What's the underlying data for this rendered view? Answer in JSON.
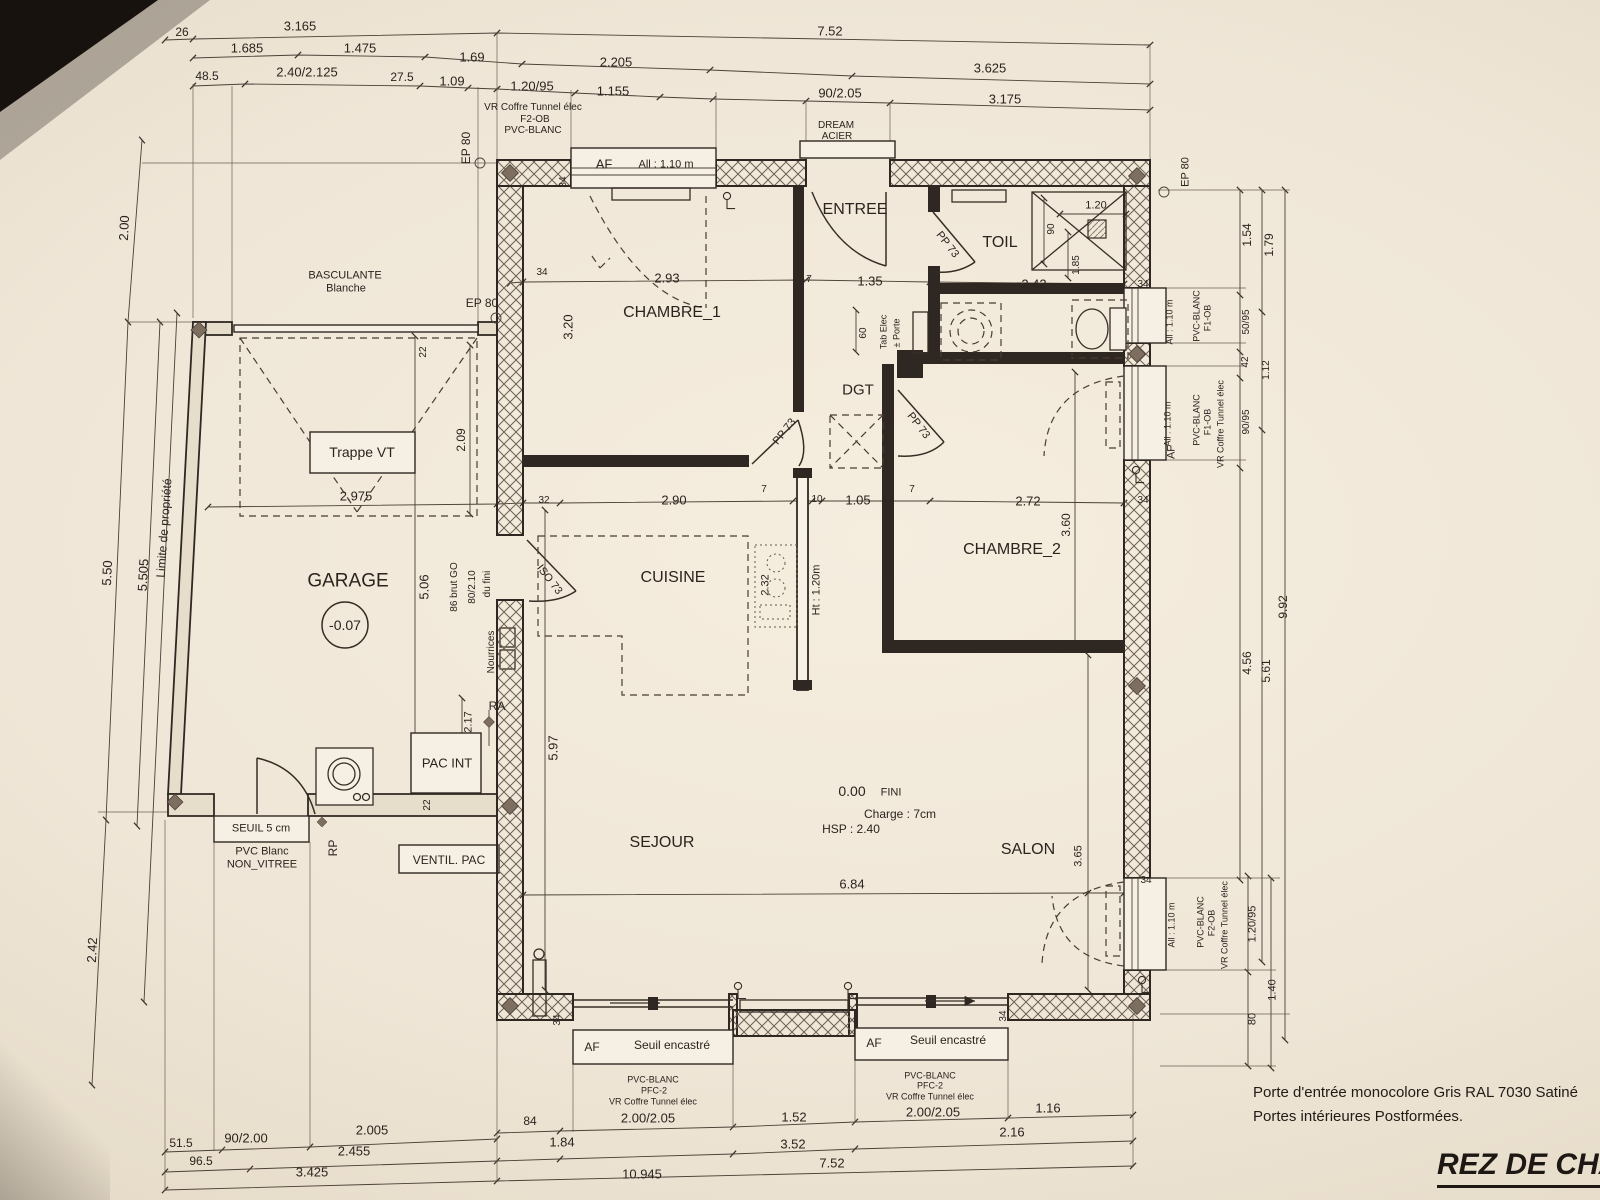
{
  "title": "REZ DE CHAU",
  "notes": [
    "Porte d'entrée monocolore Gris RAL 7030 Satiné",
    "Portes intérieures Postformées."
  ],
  "rooms": [
    "GARAGE",
    "CHAMBRE_1",
    "ENTREE",
    "TOIL",
    "DGT",
    "CHAMBRE_2",
    "CUISINE",
    "SEJOUR",
    "SALON"
  ],
  "levels": {
    "garage": "-0.07",
    "ground_floor": "0.00",
    "finish": "FINI",
    "charge": "Charge : 7cm",
    "ceiling": "HSP : 2.40"
  },
  "labels": [
    {
      "n": "dim-label",
      "t": "26",
      "x": 182,
      "y": 32,
      "s": 12
    },
    {
      "n": "dim-label",
      "t": "3.165",
      "x": 300,
      "y": 26
    },
    {
      "n": "dim-label",
      "t": "7.52",
      "x": 830,
      "y": 31
    },
    {
      "n": "dim-label",
      "t": "1.685",
      "x": 247,
      "y": 48
    },
    {
      "n": "dim-label",
      "t": "1.475",
      "x": 360,
      "y": 48
    },
    {
      "n": "dim-label",
      "t": "1.69",
      "x": 472,
      "y": 57
    },
    {
      "n": "dim-label",
      "t": "2.205",
      "x": 616,
      "y": 62
    },
    {
      "n": "dim-label",
      "t": "3.625",
      "x": 990,
      "y": 68
    },
    {
      "n": "dim-label",
      "t": "48.5",
      "x": 207,
      "y": 76,
      "s": 12
    },
    {
      "n": "dim-label",
      "t": "2.40/2.125",
      "x": 307,
      "y": 72
    },
    {
      "n": "dim-label",
      "t": "27.5",
      "x": 402,
      "y": 77,
      "s": 12
    },
    {
      "n": "dim-label",
      "t": "1.09",
      "x": 452,
      "y": 81
    },
    {
      "n": "dim-label",
      "t": "1.20/95",
      "x": 532,
      "y": 86
    },
    {
      "n": "dim-label",
      "t": "1.155",
      "x": 613,
      "y": 91
    },
    {
      "n": "dim-label",
      "t": "90/2.05",
      "x": 840,
      "y": 93
    },
    {
      "n": "dim-label",
      "t": "3.175",
      "x": 1005,
      "y": 99
    },
    {
      "n": "window-spec-label",
      "t": "VR Coffre Tunnel élec",
      "x": 533,
      "y": 108,
      "s": 10
    },
    {
      "n": "window-spec-label",
      "t": "F2-OB",
      "x": 535,
      "y": 120,
      "s": 10
    },
    {
      "n": "window-spec-label",
      "t": "PVC-BLANC",
      "x": 533,
      "y": 131,
      "s": 10
    },
    {
      "n": "door-material-label",
      "t": "DREAM",
      "x": 836,
      "y": 126,
      "s": 10
    },
    {
      "n": "door-material-label",
      "t": "ACIER",
      "x": 837,
      "y": 137,
      "s": 10
    },
    {
      "n": "dim-label",
      "t": "2.00",
      "x": 124,
      "y": 228,
      "r": -87
    },
    {
      "n": "dim-label",
      "t": "5.50",
      "x": 107,
      "y": 573,
      "r": -87
    },
    {
      "n": "dim-label",
      "t": "5.505",
      "x": 143,
      "y": 575,
      "r": -87
    },
    {
      "n": "dim-label",
      "t": "2.42",
      "x": 92,
      "y": 950,
      "r": -87
    },
    {
      "n": "property-limit-label",
      "t": "Limite de propriété",
      "x": 164,
      "y": 528,
      "r": -86,
      "s": 12
    },
    {
      "n": "wall-spec-label",
      "t": "EP 80",
      "x": 466,
      "y": 148,
      "r": -90,
      "s": 12
    },
    {
      "n": "window-label",
      "t": "AF",
      "x": 604,
      "y": 164,
      "s": 13
    },
    {
      "n": "window-label",
      "t": "All : 1.10 m",
      "x": 666,
      "y": 165,
      "s": 11
    },
    {
      "n": "room-label-entree",
      "t": "ENTREE",
      "x": 855,
      "y": 210,
      "s": 16
    },
    {
      "n": "door-label-pp73",
      "t": "PP 73",
      "x": 947,
      "y": 245,
      "r": 52,
      "s": 11
    },
    {
      "n": "room-label-toil",
      "t": "TOIL",
      "x": 1000,
      "y": 243,
      "s": 16
    },
    {
      "n": "dim-label",
      "t": "90",
      "x": 1052,
      "y": 229,
      "r": -90,
      "s": 10
    },
    {
      "n": "dim-label",
      "t": "1.20",
      "x": 1096,
      "y": 206,
      "s": 11
    },
    {
      "n": "dim-label",
      "t": "1.85",
      "x": 1077,
      "y": 265,
      "r": -90,
      "s": 10
    },
    {
      "n": "dim-label",
      "t": "2.42",
      "x": 1034,
      "y": 284
    },
    {
      "n": "dim-label",
      "t": "34",
      "x": 1143,
      "y": 285,
      "s": 10
    },
    {
      "n": "garage-door-label",
      "t": "BASCULANTE",
      "x": 345,
      "y": 276,
      "s": 11
    },
    {
      "n": "garage-door-label",
      "t": "Blanche",
      "x": 346,
      "y": 289,
      "s": 11
    },
    {
      "n": "wall-spec-label",
      "t": "EP 80",
      "x": 482,
      "y": 303,
      "s": 12
    },
    {
      "n": "dim-label",
      "t": "22",
      "x": 424,
      "y": 352,
      "r": -90,
      "s": 10
    },
    {
      "n": "dim-label",
      "t": "34",
      "x": 564,
      "y": 182,
      "r": -90,
      "s": 10
    },
    {
      "n": "dim-label",
      "t": "34",
      "x": 542,
      "y": 273,
      "s": 10
    },
    {
      "n": "dim-label",
      "t": "2.93",
      "x": 667,
      "y": 278
    },
    {
      "n": "dim-label",
      "t": "7",
      "x": 809,
      "y": 280,
      "s": 10
    },
    {
      "n": "dim-label",
      "t": "1.35",
      "x": 870,
      "y": 281
    },
    {
      "n": "dim-label",
      "t": "3.20",
      "x": 568,
      "y": 327,
      "r": -90
    },
    {
      "n": "room-label-chambre1",
      "t": "CHAMBRE_1",
      "x": 672,
      "y": 313,
      "s": 16
    },
    {
      "n": "dim-label",
      "t": "60",
      "x": 864,
      "y": 333,
      "r": -90,
      "s": 10
    },
    {
      "n": "elec-label",
      "t": "Tab Elec",
      "x": 884,
      "y": 332,
      "r": -90,
      "s": 9
    },
    {
      "n": "elec-label",
      "t": "± Porte",
      "x": 897,
      "y": 333,
      "r": -90,
      "s": 9
    },
    {
      "n": "window-spec-label",
      "t": "All : 1.10 m",
      "x": 1170,
      "y": 322,
      "r": -90,
      "s": 9
    },
    {
      "n": "window-spec-label",
      "t": "PVC-BLANC",
      "x": 1197,
      "y": 316,
      "r": -90,
      "s": 9
    },
    {
      "n": "window-spec-label",
      "t": "F1-OB",
      "x": 1208,
      "y": 318,
      "r": -90,
      "s": 9
    },
    {
      "n": "wall-spec-label",
      "t": "EP 80",
      "x": 1186,
      "y": 172,
      "r": -90,
      "s": 11
    },
    {
      "n": "dim-label",
      "t": "1.54",
      "x": 1247,
      "y": 235,
      "r": -90,
      "s": 12
    },
    {
      "n": "dim-label",
      "t": "1.79",
      "x": 1269,
      "y": 245,
      "r": -90,
      "s": 12
    },
    {
      "n": "dim-label",
      "t": "50/95",
      "x": 1247,
      "y": 322,
      "r": -90,
      "s": 10
    },
    {
      "n": "dim-label",
      "t": "42",
      "x": 1246,
      "y": 362,
      "r": -90,
      "s": 10
    },
    {
      "n": "dim-label",
      "t": "1.12",
      "x": 1267,
      "y": 370,
      "r": -90,
      "s": 10
    },
    {
      "n": "dim-label",
      "t": "90/95",
      "x": 1247,
      "y": 422,
      "r": -90,
      "s": 10
    },
    {
      "n": "window-spec-label",
      "t": "All : 1.10 m",
      "x": 1168,
      "y": 424,
      "r": -90,
      "s": 9
    },
    {
      "n": "window-label",
      "t": "AF",
      "x": 1172,
      "y": 452,
      "r": -90,
      "s": 11
    },
    {
      "n": "window-spec-label",
      "t": "PVC-BLANC",
      "x": 1197,
      "y": 420,
      "r": -90,
      "s": 9
    },
    {
      "n": "window-spec-label",
      "t": "F1-OB",
      "x": 1208,
      "y": 422,
      "r": -90,
      "s": 9
    },
    {
      "n": "window-spec-label",
      "t": "VR Coffre Tunnel élec",
      "x": 1221,
      "y": 424,
      "r": -90,
      "s": 9
    },
    {
      "n": "dim-label",
      "t": "9.92",
      "x": 1283,
      "y": 607,
      "r": -90,
      "s": 12
    },
    {
      "n": "dim-label",
      "t": "4.56",
      "x": 1247,
      "y": 663,
      "r": -90,
      "s": 12
    },
    {
      "n": "dim-label",
      "t": "5.61",
      "x": 1266,
      "y": 671,
      "r": -90,
      "s": 12
    },
    {
      "n": "room-label-dgt",
      "t": "DGT",
      "x": 858,
      "y": 390,
      "s": 15
    },
    {
      "n": "door-label-pp73",
      "t": "PP 73",
      "x": 785,
      "y": 432,
      "r": -52,
      "s": 11
    },
    {
      "n": "door-label-pp73",
      "t": "PP 73",
      "x": 918,
      "y": 426,
      "r": 52,
      "s": 11
    },
    {
      "n": "hatch-label",
      "t": "Trappe VT",
      "x": 362,
      "y": 452,
      "s": 14
    },
    {
      "n": "dim-label",
      "t": "2.09",
      "x": 461,
      "y": 440,
      "r": -90,
      "s": 12
    },
    {
      "n": "dim-label",
      "t": "2.975",
      "x": 356,
      "y": 496
    },
    {
      "n": "dim-label",
      "t": "32",
      "x": 544,
      "y": 501,
      "s": 10
    },
    {
      "n": "dim-label",
      "t": "2.90",
      "x": 674,
      "y": 500
    },
    {
      "n": "dim-label",
      "t": "7",
      "x": 764,
      "y": 490,
      "s": 10
    },
    {
      "n": "dim-label",
      "t": "10",
      "x": 817,
      "y": 500,
      "s": 10
    },
    {
      "n": "dim-label",
      "t": "1.05",
      "x": 858,
      "y": 500
    },
    {
      "n": "dim-label",
      "t": "7",
      "x": 912,
      "y": 490,
      "s": 10
    },
    {
      "n": "dim-label",
      "t": "2.72",
      "x": 1028,
      "y": 501
    },
    {
      "n": "dim-label",
      "t": "34",
      "x": 1143,
      "y": 501,
      "s": 10
    },
    {
      "n": "dim-label",
      "t": "3.60",
      "x": 1066,
      "y": 525,
      "r": -90,
      "s": 12
    },
    {
      "n": "room-label-chambre2",
      "t": "CHAMBRE_2",
      "x": 1012,
      "y": 550,
      "s": 16
    },
    {
      "n": "room-label-garage",
      "t": "GARAGE",
      "x": 348,
      "y": 581,
      "s": 19
    },
    {
      "n": "level-label-garage",
      "t": "-0.07",
      "x": 345,
      "y": 625,
      "s": 14
    },
    {
      "n": "dim-label",
      "t": "5.06",
      "x": 424,
      "y": 587,
      "r": -90
    },
    {
      "n": "dim-label",
      "t": "86 brut GO",
      "x": 455,
      "y": 587,
      "r": -90,
      "s": 10
    },
    {
      "n": "dim-label",
      "t": "80/2.10",
      "x": 473,
      "y": 587,
      "r": -90,
      "s": 10
    },
    {
      "n": "dim-label",
      "t": "du fini",
      "x": 488,
      "y": 584,
      "r": -90,
      "s": 10
    },
    {
      "n": "door-label-iso73",
      "t": "ISO 73",
      "x": 549,
      "y": 580,
      "r": 52,
      "s": 11
    },
    {
      "n": "room-label-cuisine",
      "t": "CUISINE",
      "x": 673,
      "y": 578,
      "s": 16
    },
    {
      "n": "dim-label",
      "t": "2.32",
      "x": 766,
      "y": 585,
      "r": -90,
      "s": 11
    },
    {
      "n": "dim-label",
      "t": "Ht : 1.20m",
      "x": 817,
      "y": 590,
      "r": -90,
      "s": 11
    },
    {
      "n": "plumbing-label",
      "t": "Nourrices",
      "x": 492,
      "y": 652,
      "r": -90,
      "s": 10
    },
    {
      "n": "plumbing-label",
      "t": "RA",
      "x": 497,
      "y": 706,
      "s": 12
    },
    {
      "n": "dim-label",
      "t": "2.17",
      "x": 469,
      "y": 722,
      "r": -90,
      "s": 11
    },
    {
      "n": "equipment-label",
      "t": "PAC INT",
      "x": 447,
      "y": 763,
      "s": 13
    },
    {
      "n": "dim-label",
      "t": "5.97",
      "x": 553,
      "y": 748,
      "r": -90
    },
    {
      "n": "level-label-rdc",
      "t": "0.00",
      "x": 852,
      "y": 791,
      "s": 14
    },
    {
      "n": "finish-label",
      "t": "FINI",
      "x": 891,
      "y": 793,
      "s": 11
    },
    {
      "n": "charge-label",
      "t": "Charge : 7cm",
      "x": 900,
      "y": 814,
      "s": 12
    },
    {
      "n": "ceiling-label",
      "t": "HSP : 2.40",
      "x": 851,
      "y": 829,
      "s": 12
    },
    {
      "n": "room-label-sejour",
      "t": "SEJOUR",
      "x": 662,
      "y": 843,
      "s": 16
    },
    {
      "n": "room-label-salon",
      "t": "SALON",
      "x": 1028,
      "y": 850,
      "s": 16
    },
    {
      "n": "dim-label",
      "t": "3.65",
      "x": 1079,
      "y": 856,
      "r": -90,
      "s": 11
    },
    {
      "n": "dim-label",
      "t": "6.84",
      "x": 852,
      "y": 884
    },
    {
      "n": "dim-label",
      "t": "34",
      "x": 1146,
      "y": 881,
      "s": 10
    },
    {
      "n": "dim-label",
      "t": "22",
      "x": 428,
      "y": 805,
      "r": -90,
      "s": 10
    },
    {
      "n": "dim-label",
      "t": "7",
      "x": 1057,
      "y": 650,
      "r": -90,
      "s": 10
    },
    {
      "n": "dim-label",
      "t": "7",
      "x": 1072,
      "y": 356,
      "r": -90,
      "s": 10
    },
    {
      "n": "threshold-label",
      "t": "SEUIL 5 cm",
      "x": 261,
      "y": 829,
      "s": 11
    },
    {
      "n": "door-spec-label",
      "t": "PVC Blanc",
      "x": 262,
      "y": 852,
      "s": 11
    },
    {
      "n": "door-spec-label",
      "t": "NON_VITREE",
      "x": 262,
      "y": 865,
      "s": 11
    },
    {
      "n": "plumbing-label",
      "t": "RP",
      "x": 333,
      "y": 848,
      "r": -90,
      "s": 12
    },
    {
      "n": "equipment-label",
      "t": "VENTIL. PAC",
      "x": 449,
      "y": 860,
      "s": 12
    },
    {
      "n": "dim-label",
      "t": "34",
      "x": 558,
      "y": 1020,
      "r": -90,
      "s": 10
    },
    {
      "n": "dim-label",
      "t": "34",
      "x": 1004,
      "y": 1016,
      "r": -90,
      "s": 10
    },
    {
      "n": "window-label",
      "t": "AF",
      "x": 592,
      "y": 1047,
      "s": 12
    },
    {
      "n": "threshold-label",
      "t": "Seuil encastré",
      "x": 672,
      "y": 1045,
      "s": 12
    },
    {
      "n": "window-label",
      "t": "AF",
      "x": 874,
      "y": 1043,
      "s": 12
    },
    {
      "n": "threshold-label",
      "t": "Seuil encastré",
      "x": 948,
      "y": 1040,
      "s": 12
    },
    {
      "n": "window-spec-label",
      "t": "PVC-BLANC",
      "x": 653,
      "y": 1080,
      "s": 9
    },
    {
      "n": "window-spec-label",
      "t": "PFC-2",
      "x": 654,
      "y": 1091,
      "s": 9
    },
    {
      "n": "window-spec-label",
      "t": "VR Coffre Tunnel élec",
      "x": 653,
      "y": 1102,
      "s": 9
    },
    {
      "n": "dim-label",
      "t": "2.00/2.05",
      "x": 648,
      "y": 1118
    },
    {
      "n": "window-spec-label",
      "t": "PVC-BLANC",
      "x": 930,
      "y": 1076,
      "s": 9
    },
    {
      "n": "window-spec-label",
      "t": "PFC-2",
      "x": 930,
      "y": 1086,
      "s": 9
    },
    {
      "n": "window-spec-label",
      "t": "VR Coffre Tunnel élec",
      "x": 930,
      "y": 1097,
      "s": 9
    },
    {
      "n": "dim-label",
      "t": "2.00/2.05",
      "x": 933,
      "y": 1112
    },
    {
      "n": "dim-label",
      "t": "84",
      "x": 530,
      "y": 1121,
      "s": 12
    },
    {
      "n": "dim-label",
      "t": "1.52",
      "x": 794,
      "y": 1117
    },
    {
      "n": "dim-label",
      "t": "1.16",
      "x": 1048,
      "y": 1108
    },
    {
      "n": "dim-label",
      "t": "51.5",
      "x": 181,
      "y": 1143,
      "s": 12
    },
    {
      "n": "dim-label",
      "t": "90/2.00",
      "x": 246,
      "y": 1138
    },
    {
      "n": "dim-label",
      "t": "2.005",
      "x": 372,
      "y": 1130
    },
    {
      "n": "dim-label",
      "t": "1.84",
      "x": 562,
      "y": 1142
    },
    {
      "n": "dim-label",
      "t": "96.5",
      "x": 201,
      "y": 1161,
      "s": 12
    },
    {
      "n": "dim-label",
      "t": "2.455",
      "x": 354,
      "y": 1151
    },
    {
      "n": "dim-label",
      "t": "3.52",
      "x": 793,
      "y": 1144
    },
    {
      "n": "dim-label",
      "t": "2.16",
      "x": 1012,
      "y": 1132
    },
    {
      "n": "dim-label",
      "t": "3.425",
      "x": 312,
      "y": 1172
    },
    {
      "n": "dim-label",
      "t": "10.945",
      "x": 642,
      "y": 1174
    },
    {
      "n": "dim-label",
      "t": "7.52",
      "x": 832,
      "y": 1163
    },
    {
      "n": "window-spec-label",
      "t": "All : 1.10 m",
      "x": 1172,
      "y": 925,
      "r": -90,
      "s": 9
    },
    {
      "n": "window-spec-label",
      "t": "PVC-BLANC",
      "x": 1201,
      "y": 922,
      "r": -90,
      "s": 9
    },
    {
      "n": "window-spec-label",
      "t": "F2-OB",
      "x": 1212,
      "y": 923,
      "r": -90,
      "s": 9
    },
    {
      "n": "window-spec-label",
      "t": "VR Coffre Tunnel élec",
      "x": 1225,
      "y": 925,
      "r": -90,
      "s": 9
    },
    {
      "n": "dim-label",
      "t": "1.20/95",
      "x": 1253,
      "y": 924,
      "r": -90,
      "s": 11
    },
    {
      "n": "dim-label",
      "t": "1.40",
      "x": 1273,
      "y": 990,
      "r": -90,
      "s": 11
    },
    {
      "n": "dim-label",
      "t": "80",
      "x": 1253,
      "y": 1019,
      "r": -90,
      "s": 11
    }
  ]
}
